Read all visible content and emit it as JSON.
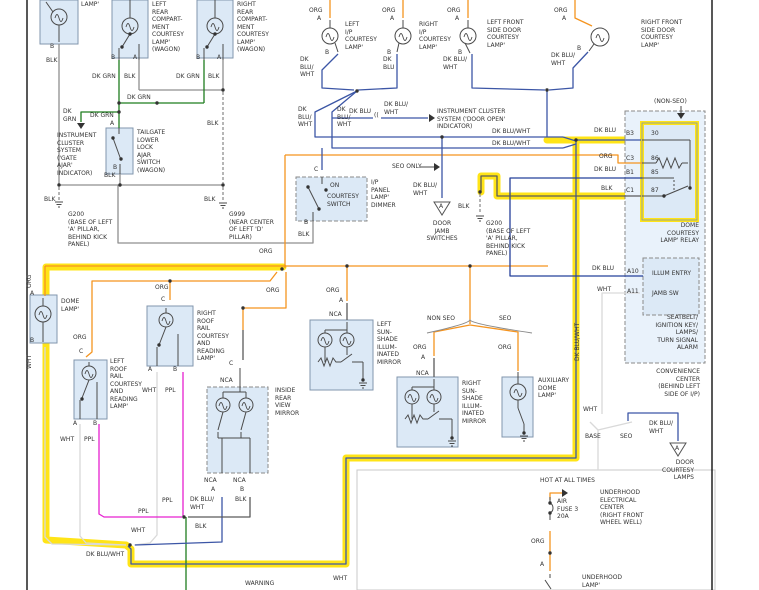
{
  "title": "Courtesy Lamp Wiring Diagram",
  "colors": {
    "bg": "#ffffff",
    "box_fill": "#dce9f6",
    "box_fill_light": "#e9f2fb",
    "box_stroke": "#8296ad",
    "dash_stroke": "#8a8a8a",
    "wire_gray": "#8f8f8f",
    "wire_dark": "#5a5a5a",
    "wire_green": "#1e7d1e",
    "wire_orange": "#f5941f",
    "wire_navy": "#3c56a6",
    "wire_navy_dark": "#25409a",
    "wire_magenta": "#e620d0",
    "wire_white": "#d9d9d9",
    "highlight": "#ffe417",
    "text": "#333333",
    "page_border": "#111111"
  },
  "labels": [
    {
      "t": "LAMP'",
      "x": 81,
      "y": 1
    },
    {
      "t": "B",
      "x": 50,
      "y": 43
    },
    {
      "t": "BLK",
      "x": 46,
      "y": 57
    },
    {
      "t": "LEFT\nREAR\nCOMPART-\nMENT\nCOURTESY\nLAMP'\n(WAGON)",
      "x": 152,
      "y": 1
    },
    {
      "t": "B",
      "x": 111,
      "y": 54
    },
    {
      "t": "A",
      "x": 133,
      "y": 54
    },
    {
      "t": "DK GRN",
      "x": 92,
      "y": 73
    },
    {
      "t": "BLK",
      "x": 124,
      "y": 73
    },
    {
      "t": "RIGHT\nREAR\nCOMPART-\nMENT\nCOURTESY\nLAMP'\n(WAGON)",
      "x": 237,
      "y": 1
    },
    {
      "t": "B",
      "x": 196,
      "y": 54
    },
    {
      "t": "A",
      "x": 217,
      "y": 54
    },
    {
      "t": "DK GRN",
      "x": 176,
      "y": 73
    },
    {
      "t": "BLK",
      "x": 208,
      "y": 73
    },
    {
      "t": "DK GRN",
      "x": 127,
      "y": 94
    },
    {
      "t": "DK\nGRN",
      "x": 63,
      "y": 108
    },
    {
      "t": "DK GRN",
      "x": 90,
      "y": 112
    },
    {
      "t": "A",
      "x": 110,
      "y": 120
    },
    {
      "t": "INSTRUMENT\nCLUSTER\nSYSTEM\n('GATE\nAJAR'\nINDICATOR)",
      "x": 57,
      "y": 132
    },
    {
      "t": "TAILGATE\nLOWER\nLOCK\nAJAR\nSWITCH\n(WAGON)",
      "x": 137,
      "y": 129
    },
    {
      "t": "B",
      "x": 113,
      "y": 164
    },
    {
      "t": "BLK",
      "x": 104,
      "y": 172
    },
    {
      "t": "BLK",
      "x": 44,
      "y": 196
    },
    {
      "t": "G200\n(BASE OF LEFT\n'A' PILLAR,\nBEHIND KICK\nPANEL)",
      "x": 68,
      "y": 211
    },
    {
      "t": "BLK",
      "x": 207,
      "y": 120
    },
    {
      "t": "BLK",
      "x": 204,
      "y": 196
    },
    {
      "t": "G999\n(NEAR CENTER\nOF LEFT 'D'\nPILLAR)",
      "x": 229,
      "y": 211
    },
    {
      "t": "ORG",
      "x": 309,
      "y": 7
    },
    {
      "t": "A",
      "x": 317,
      "y": 15
    },
    {
      "t": "LEFT\nI/P\nCOURTESY\nLAMP'",
      "x": 345,
      "y": 21
    },
    {
      "t": "B",
      "x": 325,
      "y": 49
    },
    {
      "t": "DK\nBLU/\nWHT",
      "x": 300,
      "y": 56
    },
    {
      "t": "ORG",
      "x": 382,
      "y": 7
    },
    {
      "t": "A",
      "x": 390,
      "y": 15
    },
    {
      "t": "RIGHT\nI/P\nCOURTESY\nLAMP'",
      "x": 419,
      "y": 21
    },
    {
      "t": "B",
      "x": 387,
      "y": 49
    },
    {
      "t": "DK\nBLU",
      "x": 383,
      "y": 56
    },
    {
      "t": "ORG",
      "x": 447,
      "y": 7
    },
    {
      "t": "A",
      "x": 455,
      "y": 15
    },
    {
      "t": "LEFT FRONT\nSIDE DOOR\nCOURTESY\nLAMP'",
      "x": 487,
      "y": 19
    },
    {
      "t": "B",
      "x": 458,
      "y": 49
    },
    {
      "t": "DK BLU/\nWHT",
      "x": 443,
      "y": 56
    },
    {
      "t": "ORG",
      "x": 554,
      "y": 7
    },
    {
      "t": "A",
      "x": 562,
      "y": 15
    },
    {
      "t": "RIGHT FRONT\nSIDE DOOR\nCOURTESY\nLAMP'",
      "x": 641,
      "y": 19
    },
    {
      "t": "B",
      "x": 577,
      "y": 45
    },
    {
      "t": "DK BLU/\nWHT",
      "x": 551,
      "y": 52
    },
    {
      "t": "DK\nBLU/\nWHT",
      "x": 298,
      "y": 106
    },
    {
      "t": "DK\nBLU/\nWHT",
      "x": 337,
      "y": 106
    },
    {
      "t": "DK BLU",
      "x": 349,
      "y": 108
    },
    {
      "t": "DK BLU/\nWHT",
      "x": 384,
      "y": 101
    },
    {
      "t": "INSTRUMENT CLUSTER\nSYSTEM ('DOOR OPEN'\nINDICATOR)",
      "x": 437,
      "y": 108
    },
    {
      "t": "((",
      "x": 374,
      "y": 112
    },
    {
      "t": "DK BLU/WHT",
      "x": 492,
      "y": 128
    },
    {
      "t": "DK BLU/WHT",
      "x": 492,
      "y": 140
    },
    {
      "t": "SEO ONLY",
      "x": 392,
      "y": 163
    },
    {
      "t": "DK BLU/\nWHT",
      "x": 413,
      "y": 182
    },
    {
      "t": "DOOR\nJAMB\nSWITCHES",
      "x": 442,
      "y": 220,
      "a": "c"
    },
    {
      "t": "BLK",
      "x": 458,
      "y": 203
    },
    {
      "t": "G200\n(BASE OF LEFT\n'A' PILLAR,\nBEHIND KICK\nPANEL)",
      "x": 486,
      "y": 220
    },
    {
      "t": "C",
      "x": 314,
      "y": 166
    },
    {
      "t": "ON",
      "x": 330,
      "y": 182
    },
    {
      "t": "COURTESY\nSWITCH",
      "x": 327,
      "y": 193
    },
    {
      "t": "I/P\nPANEL\nLAMP'\nDIMMER",
      "x": 371,
      "y": 179
    },
    {
      "t": "B",
      "x": 304,
      "y": 219
    },
    {
      "t": "BLK",
      "x": 298,
      "y": 231
    },
    {
      "t": "(NON-SEO)",
      "x": 654,
      "y": 98
    },
    {
      "t": "DK BLU",
      "x": 594,
      "y": 127
    },
    {
      "t": "B3",
      "x": 626,
      "y": 130
    },
    {
      "t": "30",
      "x": 651,
      "y": 130
    },
    {
      "t": "ORG",
      "x": 599,
      "y": 153
    },
    {
      "t": "C3",
      "x": 626,
      "y": 155
    },
    {
      "t": "86",
      "x": 651,
      "y": 155
    },
    {
      "t": "DK BLU",
      "x": 594,
      "y": 166
    },
    {
      "t": "B1",
      "x": 626,
      "y": 169
    },
    {
      "t": "85",
      "x": 651,
      "y": 169
    },
    {
      "t": "BLK",
      "x": 601,
      "y": 185
    },
    {
      "t": "C1",
      "x": 626,
      "y": 187
    },
    {
      "t": "87",
      "x": 651,
      "y": 187
    },
    {
      "t": "DOME\nCOURTESY\nLAMP' RELAY",
      "x": 699,
      "y": 222,
      "a": "r"
    },
    {
      "t": "A10",
      "x": 627,
      "y": 268
    },
    {
      "t": "ILLUM ENTRY",
      "x": 652,
      "y": 270
    },
    {
      "t": "A11",
      "x": 627,
      "y": 288
    },
    {
      "t": "JAMB SW",
      "x": 652,
      "y": 290
    },
    {
      "t": "DK BLU",
      "x": 592,
      "y": 265
    },
    {
      "t": "WHT",
      "x": 597,
      "y": 286
    },
    {
      "t": "SEATBELT/\nIGNITION KEY/\nLAMPS/\nTURN SIGNAL\nALARM",
      "x": 698,
      "y": 314,
      "a": "r"
    },
    {
      "t": "CONVENIENCE\nCENTER\n(BEHIND LEFT\nSIDE OF I/P)",
      "x": 700,
      "y": 368,
      "a": "r"
    },
    {
      "t": "ORG",
      "x": 259,
      "y": 248
    },
    {
      "t": "ORG",
      "x": 26,
      "y": 288,
      "r": 1
    },
    {
      "t": "A",
      "x": 30,
      "y": 290
    },
    {
      "t": "DOME\nLAMP'",
      "x": 61,
      "y": 298
    },
    {
      "t": "B",
      "x": 30,
      "y": 337
    },
    {
      "t": "WHT",
      "x": 26,
      "y": 369,
      "r": 1
    },
    {
      "t": "ORG",
      "x": 73,
      "y": 334
    },
    {
      "t": "C",
      "x": 79,
      "y": 348
    },
    {
      "t": "LEFT\nROOF\nRAIL\nCOURTESY\nAND\nREADING\nLAMP'",
      "x": 110,
      "y": 358
    },
    {
      "t": "A",
      "x": 73,
      "y": 420
    },
    {
      "t": "B",
      "x": 93,
      "y": 420
    },
    {
      "t": "WHT",
      "x": 60,
      "y": 436
    },
    {
      "t": "PPL",
      "x": 84,
      "y": 436
    },
    {
      "t": "ORG",
      "x": 155,
      "y": 284
    },
    {
      "t": "C",
      "x": 161,
      "y": 296
    },
    {
      "t": "RIGHT\nROOF\nRAIL\nCOURTESY\nAND\nREADING\nLAMP'",
      "x": 197,
      "y": 310
    },
    {
      "t": "A",
      "x": 148,
      "y": 366
    },
    {
      "t": "B",
      "x": 173,
      "y": 366
    },
    {
      "t": "WHT",
      "x": 142,
      "y": 387
    },
    {
      "t": "PPL",
      "x": 165,
      "y": 387
    },
    {
      "t": "ORG",
      "x": 266,
      "y": 287
    },
    {
      "t": "C",
      "x": 229,
      "y": 360
    },
    {
      "t": "NCA",
      "x": 220,
      "y": 377
    },
    {
      "t": "INSIDE\nREAR\nVIEW\nMIRROR",
      "x": 275,
      "y": 387
    },
    {
      "t": "NCA",
      "x": 204,
      "y": 477
    },
    {
      "t": "NCA",
      "x": 233,
      "y": 477
    },
    {
      "t": "A",
      "x": 211,
      "y": 486
    },
    {
      "t": "B",
      "x": 240,
      "y": 486
    },
    {
      "t": "DK BLU/\nWHT",
      "x": 190,
      "y": 496
    },
    {
      "t": "BLK",
      "x": 235,
      "y": 496
    },
    {
      "t": "ORG",
      "x": 326,
      "y": 287
    },
    {
      "t": "A",
      "x": 339,
      "y": 297
    },
    {
      "t": "NCA",
      "x": 329,
      "y": 311
    },
    {
      "t": "LEFT\nSUN-\nSHADE\nILLUM-\nINATED\nMIRROR",
      "x": 377,
      "y": 321
    },
    {
      "t": "NON SEO",
      "x": 427,
      "y": 315
    },
    {
      "t": "SEO",
      "x": 499,
      "y": 315
    },
    {
      "t": "ORG",
      "x": 413,
      "y": 344
    },
    {
      "t": "A",
      "x": 421,
      "y": 354
    },
    {
      "t": "NCA",
      "x": 416,
      "y": 370
    },
    {
      "t": "RIGHT\nSUN-\nSHADE\nILLUM-\nINATED\nMIRROR",
      "x": 462,
      "y": 380
    },
    {
      "t": "ORG",
      "x": 498,
      "y": 344
    },
    {
      "t": "AUXILIARY\nDOME\nLAMP'",
      "x": 538,
      "y": 377
    },
    {
      "t": "DK BLU/WHT",
      "x": 574,
      "y": 361,
      "r": 1
    },
    {
      "t": "PPL",
      "x": 162,
      "y": 497
    },
    {
      "t": "PPL",
      "x": 138,
      "y": 508
    },
    {
      "t": "BLK",
      "x": 195,
      "y": 523
    },
    {
      "t": "WHT",
      "x": 131,
      "y": 527
    },
    {
      "t": "DK BLU/WHT",
      "x": 86,
      "y": 551
    },
    {
      "t": "WARNING",
      "x": 245,
      "y": 580
    },
    {
      "t": "WHT",
      "x": 333,
      "y": 575
    },
    {
      "t": "WHT",
      "x": 583,
      "y": 406
    },
    {
      "t": "BASE",
      "x": 585,
      "y": 433
    },
    {
      "t": "SEO",
      "x": 620,
      "y": 433
    },
    {
      "t": "DK BLU/\nWHT",
      "x": 649,
      "y": 420
    },
    {
      "t": "A",
      "x": 675,
      "y": 445
    },
    {
      "t": "DOOR\nCOURTESY\nLAMPS",
      "x": 694,
      "y": 459,
      "a": "r"
    },
    {
      "t": "HOT AT ALL TIMES",
      "x": 540,
      "y": 477
    },
    {
      "t": "AIR\nFUSE 3\n20A",
      "x": 557,
      "y": 498
    },
    {
      "t": "UNDERHOOD\nELECTRICAL\nCENTER\n(RIGHT FRONT\nWHEEL WELL)",
      "x": 600,
      "y": 489
    },
    {
      "t": "ORG",
      "x": 531,
      "y": 538
    },
    {
      "t": "A",
      "x": 540,
      "y": 561
    },
    {
      "t": "UNDERHOOD\nLAMP'",
      "x": 582,
      "y": 574
    },
    {
      "t": "A",
      "x": 439,
      "y": 203
    }
  ]
}
